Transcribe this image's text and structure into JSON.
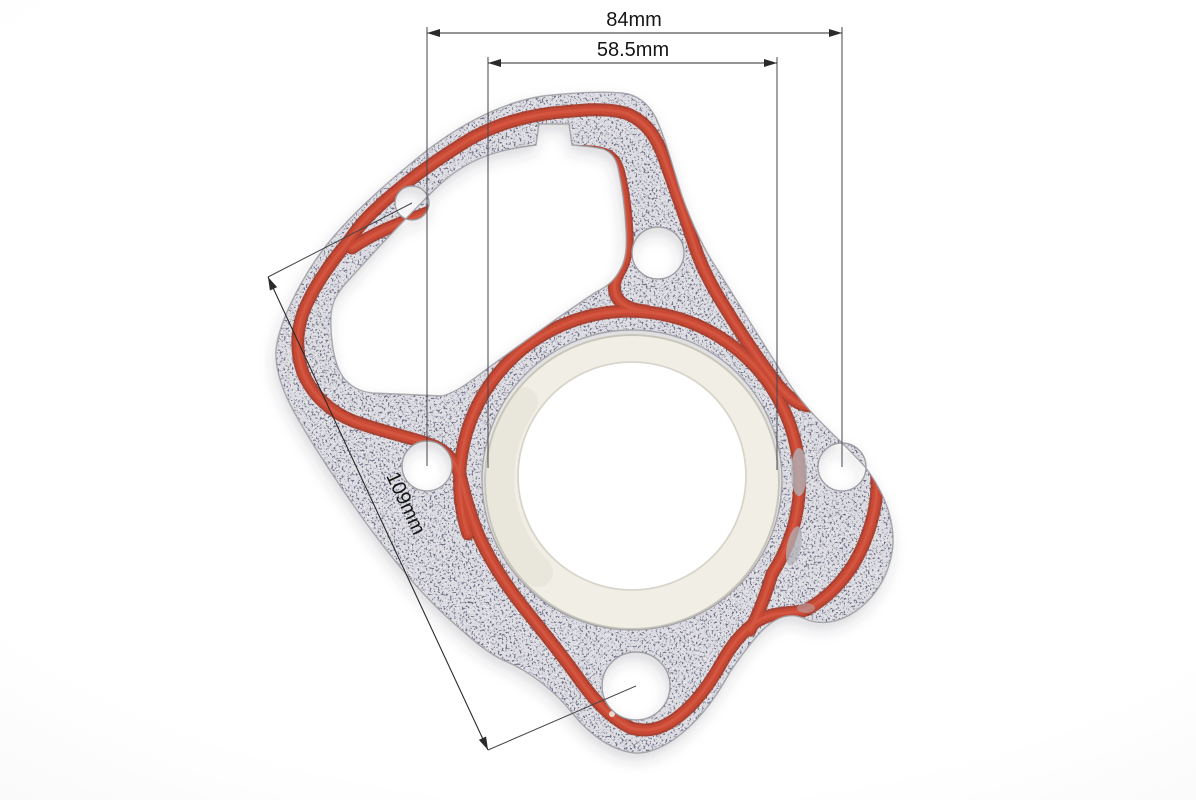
{
  "meta": {
    "description": "Product photo of a motorcycle cylinder head gasket (grey fiber gasket with red silicone sealing bead and metal fire ring) annotated with dimension lines",
    "background_color": "#ffffff"
  },
  "annotations": {
    "outer_width": {
      "label": "84mm"
    },
    "bore_diameter": {
      "label": "58.5mm"
    },
    "diagonal_bolt_spacing": {
      "label": "109mm"
    }
  },
  "part": {
    "name": "cylinder-head-gasket",
    "features": {
      "bolt_holes": 5,
      "central_bore": 1,
      "cam_chain_cutout": 1
    },
    "colors": {
      "gasket_gray": "#b2b2b7",
      "speckle_dark": "#55555e",
      "speckle_light": "#ffffff",
      "seal_bead_red": "#c94936",
      "seal_bead_edge": "#a63322",
      "seal_bead_highlight": "#d65c45",
      "fire_ring_cream": "#f1eee5",
      "ring_edge_line": "#c8c5bb",
      "dimension_line": "#2a2a2a",
      "label_text": "#151515"
    }
  }
}
